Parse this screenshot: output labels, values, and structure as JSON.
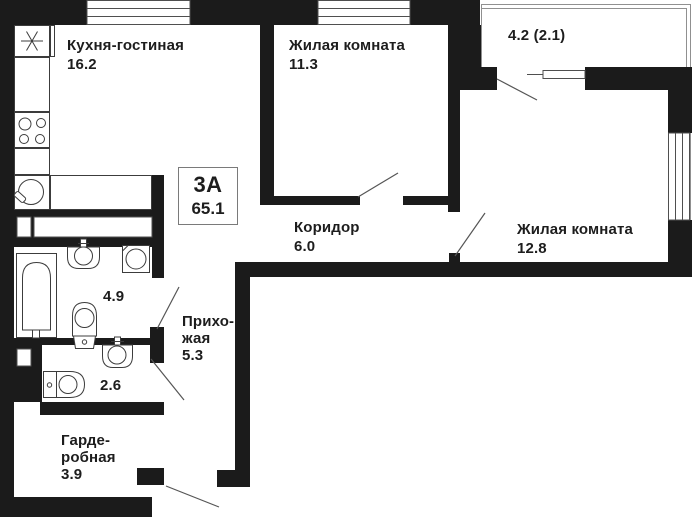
{
  "plan": {
    "badge": {
      "type_label": "3А",
      "total_area": "65.1"
    },
    "rooms": {
      "kitchen_living": {
        "name": "Кухня-гостиная",
        "area": "16.2"
      },
      "living_room_1": {
        "name": "Жилая комната",
        "area": "11.3"
      },
      "balcony": {
        "area": "4.2 (2.1)"
      },
      "corridor": {
        "name": "Коридор",
        "area": "6.0"
      },
      "living_room_2": {
        "name": "Жилая комната",
        "area": "12.8"
      },
      "bathroom": {
        "area": "4.9"
      },
      "wc": {
        "area": "2.6"
      },
      "hallway": {
        "name_line_1": "Прихо-",
        "name_line_2": "жая",
        "area": "5.3"
      },
      "wardrobe": {
        "name_line_1": "Гарде-",
        "name_line_2": "робная",
        "area": "3.9"
      }
    },
    "icons": [
      "ventilation-icon",
      "stove-icon",
      "kitchen-sink-icon",
      "bathtub-icon",
      "washbasin-icon",
      "washing-machine-icon",
      "toilet-icon",
      "door-swing-icon",
      "window-icon"
    ],
    "colors": {
      "wall": "#1b1b1b",
      "thin_line": "#4f4f4f",
      "fixture_line": "#3c3c3c",
      "balcony_outline": "#909090",
      "background": "#ffffff",
      "text": "#1d1d1d"
    }
  }
}
